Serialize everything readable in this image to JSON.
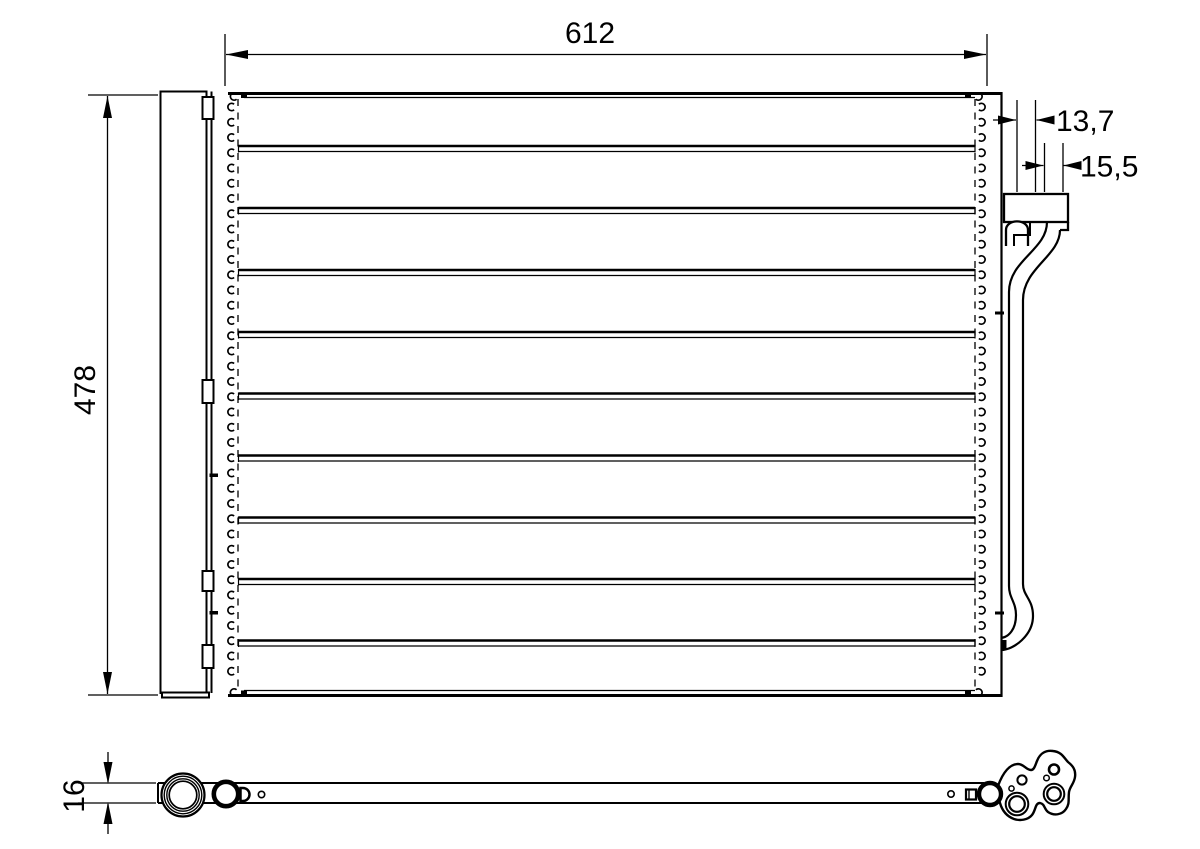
{
  "drawing": {
    "kind": "condenser-technical-drawing",
    "dimensions": {
      "core_width": "612",
      "core_height": "478",
      "connector_depth_upper": "13,7",
      "connector_depth_lower": "15,5",
      "core_thickness": "16"
    }
  }
}
